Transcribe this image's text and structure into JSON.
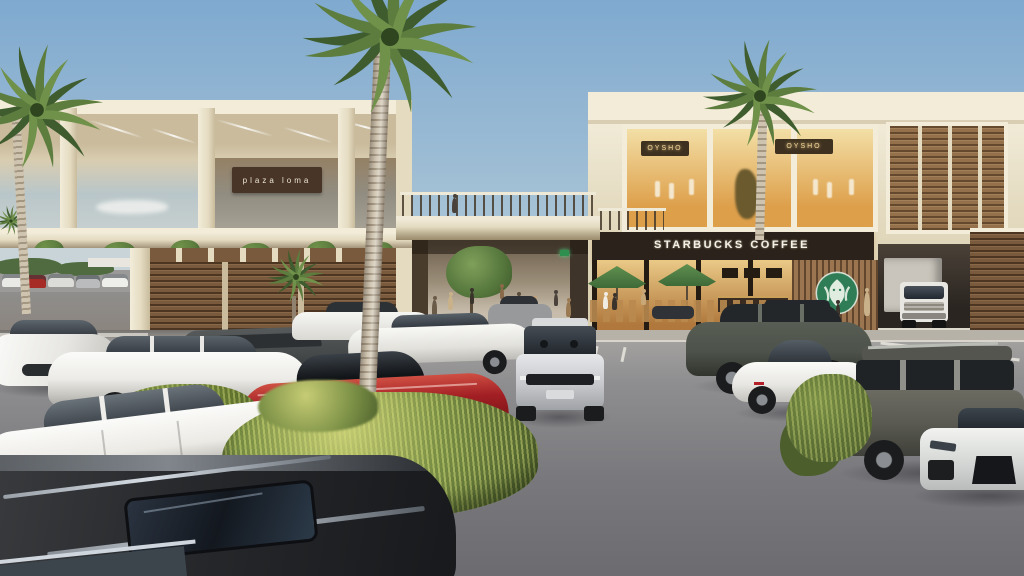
{
  "signs": {
    "plaza": "plaza loma",
    "coffee": "STARBUCKS COFFEE",
    "retail_left": "OYSHO",
    "retail_right": "OYSHO"
  },
  "icons": {
    "starbucks_siren": "green circle with white siren figure",
    "palm_tree": "tropical palm crown"
  },
  "palette": {
    "sky-top": "#7fa9cf",
    "sky-mid": "#a9c4d6",
    "sky-horizon": "#cfd9dc",
    "cream-bright": "#f2ecd9",
    "cream": "#e4dbc1",
    "cream-shade": "#c9bb9c",
    "slab-shadow": "#a3947a",
    "ceiling-warm": "#d9cdb0",
    "wood": "#7a5a3c",
    "wood-dark": "#4a3523",
    "wood-light": "#95714b",
    "slat-wood": "#9b7450",
    "sign-bg": "#483527",
    "sign-text": "#ece4d4",
    "fascia-bg": "#2b231b",
    "fascia-text": "#f4f1e9",
    "retail-sign-bg": "#3e3120",
    "retail-sign-text": "#f4d79c",
    "glass-warm-1": "#f3dfa6",
    "glass-warm-2": "#dd9f4a",
    "interior-1": "#eac987",
    "interior-2": "#b0783c",
    "umbrella": "#5f8f4f",
    "siren-green": "#2f7d57",
    "asphalt-1": "#a8a6a3",
    "asphalt-2": "#6c6c70",
    "curb": "#b7b2a7",
    "grass-dark": "#4c5e2c",
    "grass-mid": "#7a8f45",
    "grass-light": "#c6cc74",
    "frond-dark": "#3f5c2e",
    "frond-mid": "#5d7d3f",
    "frond-light": "#6f9149",
    "trunk-light": "#cfc4b0",
    "trunk-dark": "#a49782",
    "car-white": "#f4f4f1",
    "car-glass": "#2f353b",
    "car-red": "#a21f24",
    "car-silver": "#c9cbcd",
    "car-darkgrey": "#46494a",
    "car-olive": "#62625a",
    "car-greensuv": "#4d524a",
    "suv-dark": "#26282b",
    "truck-box": "#c9c5bc",
    "truck-cab": "#e9e7e1",
    "distant-tree": "#4f6b3f",
    "people-tan": "#c9a878",
    "shadow": "rgba(25,25,30,0.4)"
  }
}
